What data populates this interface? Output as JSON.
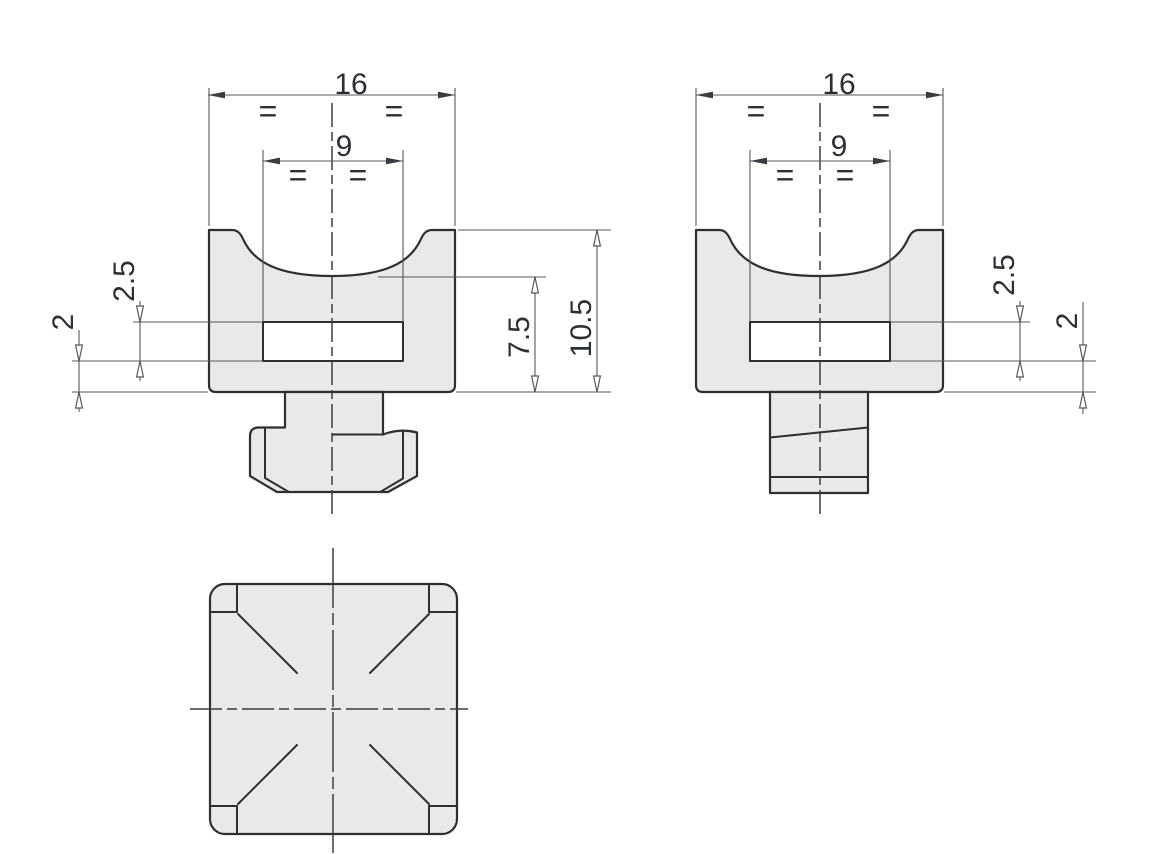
{
  "colors": {
    "background": "#ffffff",
    "part_fill": "#e8e9ea",
    "outline": "#2d2f31",
    "thin_line": "#55585c",
    "centerline": "#3b3d40",
    "text": "#2c3036",
    "arrow_fill": "#3a3d40"
  },
  "front_view": {
    "dim_width": "16",
    "dim_slot_width": "9",
    "dim_slot_height": "2.5",
    "dim_base_thickness": "2",
    "dim_cavity_height": "7.5",
    "dim_total_height": "10.5",
    "equal_mark_1": "=",
    "equal_mark_2": "=",
    "equal_mark_3": "=",
    "equal_mark_4": "="
  },
  "side_view": {
    "dim_width": "16",
    "dim_slot_width": "9",
    "dim_slot_height": "2.5",
    "dim_base_thickness": "2",
    "equal_mark_1": "=",
    "equal_mark_2": "=",
    "equal_mark_3": "=",
    "equal_mark_4": "="
  }
}
